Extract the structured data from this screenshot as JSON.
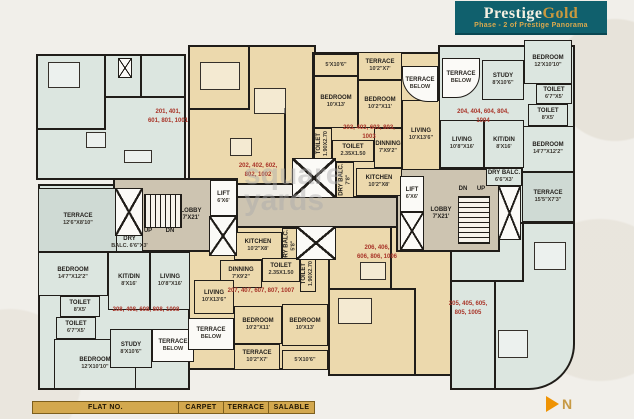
{
  "header": {
    "brand_prestige": "Prestige",
    "brand_gold": "Gold",
    "subtitle": "Phase - 2 of Prestige Panorama"
  },
  "watermark": {
    "line1": "square",
    "line2": "yards"
  },
  "compass": {
    "label": "N"
  },
  "legend": {
    "columns": [
      "FLAT NO.",
      "CARPET",
      "TERRACE",
      "SALABLE"
    ]
  },
  "colors": {
    "brand_teal": "#10606d",
    "brand_gold": "#c9993f",
    "flat_number_red": "#a93529",
    "room_mint": "#dce6e0",
    "room_tan": "#ecd9ad",
    "terrace_green": "#cfdad4",
    "lobby_gray": "#cdc4b1",
    "wall_dark": "#201d19",
    "legend_gold": "#d3a84e"
  },
  "plan": {
    "panels": [
      {
        "name": "unit-201-panel",
        "fill": "mint",
        "x": 36,
        "y": 54,
        "w": 150,
        "h": 126
      },
      {
        "name": "unit-202-panel",
        "fill": "tan",
        "x": 188,
        "y": 45,
        "w": 128,
        "h": 140
      },
      {
        "name": "unit-203-panel",
        "fill": "tan",
        "x": 312,
        "y": 52,
        "w": 128,
        "h": 146
      },
      {
        "name": "unit-204-panel",
        "fill": "mint",
        "x": 438,
        "y": 45,
        "w": 137,
        "h": 180
      },
      {
        "name": "unit-205-panel",
        "fill": "mint",
        "x": 450,
        "y": 222,
        "w": 125,
        "h": 168,
        "br": "0 0 46px 0"
      },
      {
        "name": "unit-206-panel",
        "fill": "tan",
        "x": 328,
        "y": 226,
        "w": 124,
        "h": 150
      },
      {
        "name": "unit-207-panel",
        "fill": "tan",
        "x": 188,
        "y": 226,
        "w": 142,
        "h": 144
      },
      {
        "name": "unit-208-panel",
        "fill": "mint",
        "x": 38,
        "y": 184,
        "w": 152,
        "h": 206
      },
      {
        "name": "lobby-left-panel",
        "fill": "lobby",
        "x": 113,
        "y": 178,
        "w": 125,
        "h": 74
      },
      {
        "name": "corridor-panel",
        "fill": "lobby",
        "x": 236,
        "y": 196,
        "w": 164,
        "h": 32
      },
      {
        "name": "lobby-right-panel",
        "fill": "lobby",
        "x": 396,
        "y": 168,
        "w": 104,
        "h": 84
      }
    ],
    "rooms": [
      {
        "name": "terrace-left",
        "label": "TERRACE",
        "dims": "12'6\"X8'10\"",
        "x": 38,
        "y": 188,
        "w": 80,
        "h": 64,
        "fill": "terrace"
      },
      {
        "name": "dry-balc-left",
        "label": "DRY",
        "dims": "BALC. 6'6\"X3'",
        "x": 116,
        "y": 234,
        "w": 27,
        "h": 18,
        "fill": "mint"
      },
      {
        "name": "bedroom-left-upper",
        "label": "BEDROOM",
        "dims": "14'7\"X12'2\"",
        "x": 38,
        "y": 252,
        "w": 70,
        "h": 44,
        "fill": "mint"
      },
      {
        "name": "toilet-left-upper",
        "label": "TOILET",
        "dims": "8'X5'",
        "x": 60,
        "y": 296,
        "w": 40,
        "h": 21,
        "fill": "mint"
      },
      {
        "name": "toilet-left-lower",
        "label": "TOILET",
        "dims": "6'7\"X5'",
        "x": 56,
        "y": 317,
        "w": 40,
        "h": 22,
        "fill": "mint"
      },
      {
        "name": "bedroom-left-lower",
        "label": "BEDROOM",
        "dims": "12'X10'10\"",
        "x": 54,
        "y": 339,
        "w": 82,
        "h": 50,
        "fill": "mint"
      },
      {
        "name": "study-left",
        "label": "STUDY",
        "dims": "8'X10'6\"",
        "x": 110,
        "y": 329,
        "w": 42,
        "h": 39,
        "fill": "mint"
      },
      {
        "name": "terrace-below-left",
        "label": "TERRACE",
        "dims": "BELOW",
        "x": 152,
        "y": 329,
        "w": 42,
        "h": 33,
        "fill": "white"
      },
      {
        "name": "kitdin-left",
        "label": "KIT/DIN",
        "dims": "8'X16'",
        "x": 108,
        "y": 252,
        "w": 42,
        "h": 58,
        "fill": "mint"
      },
      {
        "name": "living-left",
        "label": "LIVING",
        "dims": "10'8\"X16'",
        "x": 150,
        "y": 252,
        "w": 40,
        "h": 58,
        "fill": "mint"
      },
      {
        "name": "terrace-strip-203",
        "label": "",
        "dims": "5'X10'6\"",
        "x": 314,
        "y": 54,
        "w": 44,
        "h": 22,
        "fill": "tan"
      },
      {
        "name": "terrace-203",
        "label": "TERRACE",
        "dims": "10'2\"X7'",
        "x": 358,
        "y": 52,
        "w": 44,
        "h": 28,
        "fill": "tan"
      },
      {
        "name": "bedroom-203-a",
        "label": "BEDROOM",
        "dims": "10'X13'",
        "x": 314,
        "y": 76,
        "w": 44,
        "h": 52,
        "fill": "tan"
      },
      {
        "name": "bedroom-203-b",
        "label": "BEDROOM",
        "dims": "10'2\"X11'",
        "x": 358,
        "y": 80,
        "w": 44,
        "h": 48,
        "fill": "tan"
      },
      {
        "name": "toilet-203-vertical",
        "label": "TOILET",
        "dims": "1.90X2.70",
        "x": 314,
        "y": 128,
        "w": 18,
        "h": 32,
        "fill": "tan",
        "vertical": true
      },
      {
        "name": "toilet-203",
        "label": "TOILET",
        "dims": "2.35X1.50",
        "x": 332,
        "y": 140,
        "w": 42,
        "h": 22,
        "fill": "tan"
      },
      {
        "name": "dinning-203",
        "label": "DINNING",
        "dims": "7'X9'2\"",
        "x": 374,
        "y": 128,
        "w": 28,
        "h": 40,
        "fill": "tan"
      },
      {
        "name": "living-203",
        "label": "LIVING",
        "dims": "10'X13'6\"",
        "x": 402,
        "y": 100,
        "w": 38,
        "h": 70,
        "fill": "tan"
      },
      {
        "name": "kitchen-203",
        "label": "KITCHEN",
        "dims": "10'2\"X8'",
        "x": 356,
        "y": 168,
        "w": 46,
        "h": 28,
        "fill": "tan"
      },
      {
        "name": "dry-balc-203-vertical",
        "label": "DRY BALC.",
        "dims": "7'8\"",
        "x": 336,
        "y": 162,
        "w": 18,
        "h": 36,
        "fill": "tan",
        "vertical": true
      },
      {
        "name": "terrace-below-right-1",
        "label": "TERRACE",
        "dims": "BELOW",
        "x": 402,
        "y": 66,
        "w": 36,
        "h": 36,
        "fill": "white",
        "br": "0 0 0 26px"
      },
      {
        "name": "terrace-below-right-2",
        "label": "TERRACE",
        "dims": "BELOW",
        "x": 442,
        "y": 58,
        "w": 38,
        "h": 40,
        "fill": "white",
        "br": "0 0 24px 0"
      },
      {
        "name": "study-204",
        "label": "STUDY",
        "dims": "8'X10'6\"",
        "x": 482,
        "y": 60,
        "w": 42,
        "h": 40,
        "fill": "mint"
      },
      {
        "name": "bedroom-204-a",
        "label": "BEDROOM",
        "dims": "12'X10'10\"",
        "x": 524,
        "y": 40,
        "w": 48,
        "h": 44,
        "fill": "mint"
      },
      {
        "name": "toilet-204-a",
        "label": "TOILET",
        "dims": "6'7\"X5'",
        "x": 536,
        "y": 84,
        "w": 36,
        "h": 20,
        "fill": "mint"
      },
      {
        "name": "toilet-204-b",
        "label": "TOILET",
        "dims": "8'X5'",
        "x": 528,
        "y": 104,
        "w": 40,
        "h": 22,
        "fill": "mint"
      },
      {
        "name": "bedroom-204-b",
        "label": "BEDROOM",
        "dims": "14'7\"X12'2\"",
        "x": 522,
        "y": 126,
        "w": 52,
        "h": 46,
        "fill": "mint"
      },
      {
        "name": "living-204",
        "label": "LIVING",
        "dims": "10'8\"X16'",
        "x": 440,
        "y": 120,
        "w": 44,
        "h": 48,
        "fill": "mint"
      },
      {
        "name": "kitdin-204",
        "label": "KIT/DIN",
        "dims": "8'X16'",
        "x": 484,
        "y": 120,
        "w": 40,
        "h": 48,
        "fill": "mint"
      },
      {
        "name": "dry-balc-204",
        "label": "DRY BALC.",
        "dims": "6'6\"X3'",
        "x": 486,
        "y": 168,
        "w": 36,
        "h": 18,
        "fill": "mint"
      },
      {
        "name": "terrace-204",
        "label": "TERRACE",
        "dims": "15'5\"X7'3\"",
        "x": 522,
        "y": 172,
        "w": 52,
        "h": 50,
        "fill": "terrace"
      },
      {
        "name": "lift-left",
        "label": "LIFT",
        "dims": "6'X6'",
        "x": 210,
        "y": 180,
        "w": 27,
        "h": 36,
        "fill": "white"
      },
      {
        "name": "lift-right",
        "label": "LIFT",
        "dims": "6'X6'",
        "x": 400,
        "y": 176,
        "w": 24,
        "h": 36,
        "fill": "white"
      },
      {
        "name": "kitchen-207",
        "label": "KITCHEN",
        "dims": "10'2\"X8'",
        "x": 234,
        "y": 232,
        "w": 48,
        "h": 28,
        "fill": "tan"
      },
      {
        "name": "dry-balc-207-vertical",
        "label": "DRY BALC.",
        "dims": "5'8\"",
        "x": 282,
        "y": 228,
        "w": 16,
        "h": 36,
        "fill": "tan",
        "vertical": true
      },
      {
        "name": "dinning-207",
        "label": "DINNING",
        "dims": "7'X9'2\"",
        "x": 220,
        "y": 260,
        "w": 42,
        "h": 28,
        "fill": "tan"
      },
      {
        "name": "toilet-207",
        "label": "TOILET",
        "dims": "2.35X1.50",
        "x": 262,
        "y": 258,
        "w": 38,
        "h": 24,
        "fill": "tan"
      },
      {
        "name": "toilet-207-vertical",
        "label": "TOILET",
        "dims": "1.90X2.70",
        "x": 300,
        "y": 256,
        "w": 16,
        "h": 36,
        "fill": "tan",
        "vertical": true
      },
      {
        "name": "living-207",
        "label": "LIVING",
        "dims": "10'X13'6\"",
        "x": 194,
        "y": 280,
        "w": 40,
        "h": 34,
        "fill": "tan"
      },
      {
        "name": "bedroom-207-a",
        "label": "BEDROOM",
        "dims": "10'2\"X11'",
        "x": 234,
        "y": 306,
        "w": 48,
        "h": 38,
        "fill": "tan"
      },
      {
        "name": "bedroom-207-b",
        "label": "BEDROOM",
        "dims": "10'X13'",
        "x": 282,
        "y": 304,
        "w": 46,
        "h": 42,
        "fill": "tan"
      },
      {
        "name": "terrace-207",
        "label": "TERRACE",
        "dims": "10'2\"X7'",
        "x": 234,
        "y": 344,
        "w": 46,
        "h": 26,
        "fill": "tan"
      },
      {
        "name": "terrace-strip-207",
        "label": "",
        "dims": "5'X10'6\"",
        "x": 282,
        "y": 350,
        "w": 46,
        "h": 20,
        "fill": "tan"
      },
      {
        "name": "terrace-below-bottom",
        "label": "TERRACE",
        "dims": "BELOW",
        "x": 188,
        "y": 318,
        "w": 46,
        "h": 32,
        "fill": "white"
      }
    ],
    "flat_labels": [
      {
        "name": "flat-numbers-201",
        "lines": [
          "201, 401,",
          "601, 801, 1001"
        ],
        "x": 138,
        "y": 107,
        "w": 60,
        "h": 20
      },
      {
        "name": "flat-numbers-202",
        "lines": [
          "202, 402, 602,",
          "802, 1002"
        ],
        "x": 232,
        "y": 162,
        "w": 52,
        "h": 18
      },
      {
        "name": "flat-numbers-203",
        "lines": [
          "203, 403, 603, 803, 1003"
        ],
        "x": 336,
        "y": 128,
        "w": 66,
        "h": 10
      },
      {
        "name": "flat-numbers-204",
        "lines": [
          "204, 404, 604, 804, 1004"
        ],
        "x": 450,
        "y": 112,
        "w": 66,
        "h": 10
      },
      {
        "name": "flat-numbers-205",
        "lines": [
          "205, 405, 605,",
          "805, 1005"
        ],
        "x": 440,
        "y": 300,
        "w": 56,
        "h": 18
      },
      {
        "name": "flat-numbers-206",
        "lines": [
          "206, 406,",
          "606, 806, 1006"
        ],
        "x": 350,
        "y": 244,
        "w": 54,
        "h": 18
      },
      {
        "name": "flat-numbers-207",
        "lines": [
          "207, 407, 607, 807, 1007"
        ],
        "x": 226,
        "y": 286,
        "w": 70,
        "h": 10
      },
      {
        "name": "flat-numbers-208",
        "lines": [
          "208, 408, 608, 808, 1008"
        ],
        "x": 110,
        "y": 305,
        "w": 72,
        "h": 10
      }
    ],
    "small_labels": [
      {
        "name": "stairs-up-left",
        "lines": [
          "UP"
        ],
        "x": 140,
        "y": 228,
        "w": 16,
        "h": 8
      },
      {
        "name": "stairs-dn-left",
        "lines": [
          "DN"
        ],
        "x": 162,
        "y": 228,
        "w": 16,
        "h": 8
      },
      {
        "name": "lobby-left-label",
        "lines": [
          "LOBBY",
          "7'X21'"
        ],
        "x": 168,
        "y": 207,
        "w": 46,
        "h": 16
      },
      {
        "name": "stairs-dn-right",
        "lines": [
          "DN"
        ],
        "x": 455,
        "y": 186,
        "w": 16,
        "h": 8
      },
      {
        "name": "stairs-up-right",
        "lines": [
          "UP"
        ],
        "x": 473,
        "y": 186,
        "w": 16,
        "h": 8
      },
      {
        "name": "lobby-right-label",
        "lines": [
          "LOBBY",
          "7'X21'"
        ],
        "x": 418,
        "y": 206,
        "w": 46,
        "h": 16
      }
    ],
    "shafts": [
      {
        "name": "shaft-top-left",
        "x": 118,
        "y": 58,
        "w": 14,
        "h": 20
      },
      {
        "name": "shaft-left-outer",
        "x": 115,
        "y": 188,
        "w": 28,
        "h": 48
      },
      {
        "name": "shaft-lift-left",
        "x": 209,
        "y": 216,
        "w": 28,
        "h": 40
      },
      {
        "name": "shaft-center-top",
        "x": 292,
        "y": 158,
        "w": 44,
        "h": 40
      },
      {
        "name": "shaft-center-bottom",
        "x": 296,
        "y": 226,
        "w": 40,
        "h": 34
      },
      {
        "name": "shaft-lift-right",
        "x": 400,
        "y": 212,
        "w": 24,
        "h": 38
      },
      {
        "name": "shaft-right-outer",
        "x": 498,
        "y": 186,
        "w": 23,
        "h": 54
      }
    ],
    "stairs": [
      {
        "name": "staircase-left",
        "dir": "v",
        "x": 144,
        "y": 194,
        "w": 38,
        "h": 34
      },
      {
        "name": "staircase-right",
        "dir": "h",
        "x": 458,
        "y": 196,
        "w": 32,
        "h": 48
      }
    ],
    "walls": [
      {
        "x": 104,
        "y": 54,
        "w": 2,
        "h": 76
      },
      {
        "x": 36,
        "y": 128,
        "w": 70,
        "h": 2
      },
      {
        "x": 104,
        "y": 96,
        "w": 82,
        "h": 2
      },
      {
        "x": 140,
        "y": 54,
        "w": 2,
        "h": 44
      },
      {
        "x": 248,
        "y": 45,
        "w": 2,
        "h": 64
      },
      {
        "x": 190,
        "y": 108,
        "w": 60,
        "h": 2
      },
      {
        "x": 284,
        "y": 108,
        "w": 2,
        "h": 77
      },
      {
        "x": 522,
        "y": 222,
        "w": 2,
        "h": 60
      },
      {
        "x": 450,
        "y": 280,
        "w": 72,
        "h": 2
      },
      {
        "x": 494,
        "y": 282,
        "w": 2,
        "h": 108
      },
      {
        "x": 390,
        "y": 226,
        "w": 2,
        "h": 64
      },
      {
        "x": 330,
        "y": 288,
        "w": 84,
        "h": 2
      },
      {
        "x": 414,
        "y": 288,
        "w": 2,
        "h": 88
      }
    ],
    "furniture": [
      {
        "x": 48,
        "y": 62,
        "w": 32,
        "h": 26
      },
      {
        "x": 86,
        "y": 132,
        "w": 20,
        "h": 16
      },
      {
        "x": 124,
        "y": 150,
        "w": 28,
        "h": 13
      },
      {
        "x": 200,
        "y": 62,
        "w": 40,
        "h": 28
      },
      {
        "x": 254,
        "y": 88,
        "w": 32,
        "h": 26
      },
      {
        "x": 230,
        "y": 138,
        "w": 22,
        "h": 18
      },
      {
        "x": 534,
        "y": 242,
        "w": 32,
        "h": 28
      },
      {
        "x": 498,
        "y": 330,
        "w": 30,
        "h": 28
      },
      {
        "x": 360,
        "y": 262,
        "w": 26,
        "h": 18
      },
      {
        "x": 338,
        "y": 298,
        "w": 34,
        "h": 26
      }
    ]
  }
}
